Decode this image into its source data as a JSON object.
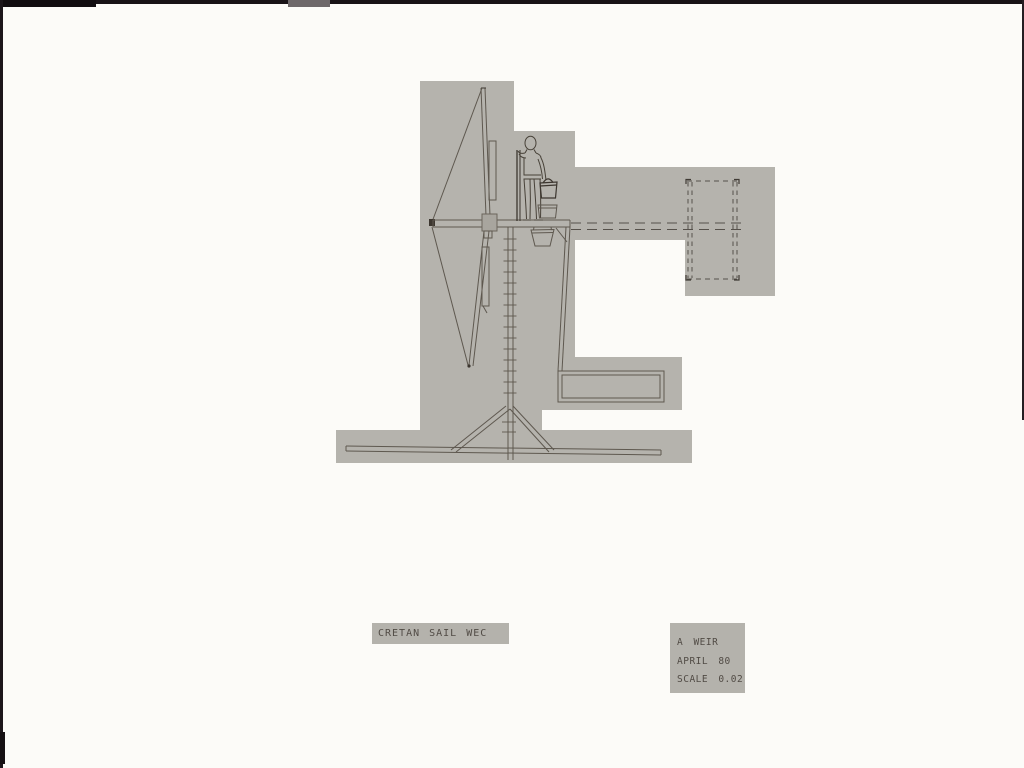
{
  "title_block": {
    "text": "CRETAN SAIL WEC",
    "words": [
      "CRETAN",
      "SAIL",
      "WEC"
    ]
  },
  "info_block": {
    "author": "A WEIR",
    "date": "APRIL 80",
    "scale": "SCALE 0.02"
  },
  "colors": {
    "page": "#fcfbf8",
    "photo_frame": "#181216",
    "paper_gray": "#b5b3ad",
    "ink": "#5e584f",
    "dark_ink": "#3c362f",
    "hub_fill": "#a8a59e",
    "label_text": "#514b45"
  },
  "drawing_parts": [
    "sail-rotor",
    "rotor-hub",
    "mast-with-ladder",
    "operator-figure",
    "platform",
    "buckets",
    "support-leg",
    "drive-shaft-dashed",
    "pump-box-dashed",
    "water-trough",
    "tripod-base",
    "ground-beam"
  ]
}
